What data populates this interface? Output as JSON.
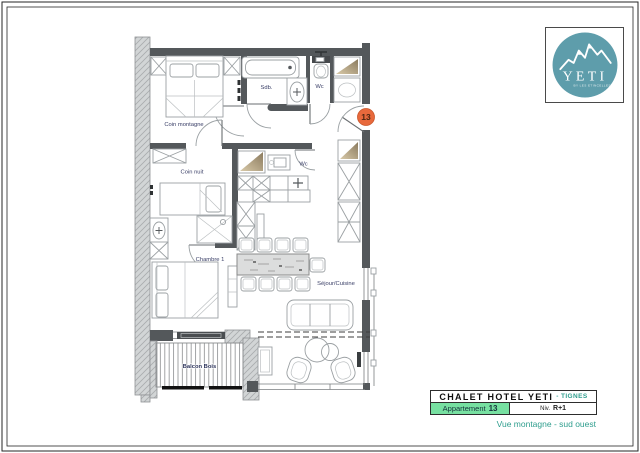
{
  "sheet": {
    "background": "#ffffff",
    "border_color": "#262626"
  },
  "logo": {
    "name": "YETI",
    "tagline": "BY LES ETINCELLES",
    "circle_color": "#5e9dab",
    "text_color": "#ffffff"
  },
  "plan": {
    "badge": {
      "number": "13",
      "fill": "#e8693c"
    },
    "label_color": "#3b4068",
    "labels": {
      "coin_montagne": "Coin montagne",
      "coin_nuit": "Coin nuit",
      "chambre_1": "Chambre 1",
      "sejour_cuisine": "Séjour/Cuisine",
      "sdb": "Sdb.",
      "wc_top": "Wc",
      "wc_mid": "Wc",
      "balcon": "Balcon Bois"
    }
  },
  "title_block": {
    "hotel": "CHALET HOTEL YETI",
    "location": "- TIGNES",
    "apartment_label": "Appartement",
    "apartment_number": "13",
    "level_label": "Niv.",
    "level_value": "R+1",
    "caption": "Vue montagne - sud ouest",
    "accent_green": "#77e0a1",
    "accent_teal": "#2f9e8e"
  }
}
